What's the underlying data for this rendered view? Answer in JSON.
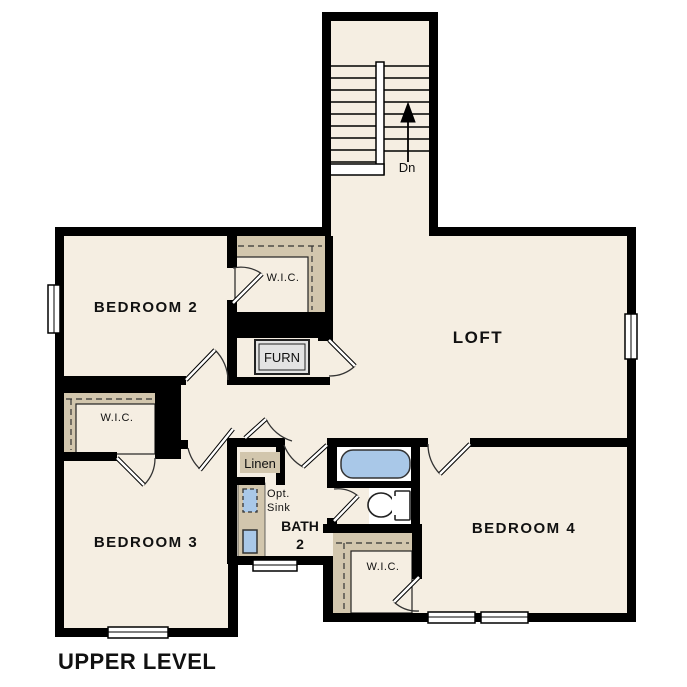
{
  "title": "UPPER LEVEL",
  "colors": {
    "floor": "#f5eee2",
    "wall": "#000000",
    "shelf": "#d2c6ad",
    "fixture": "#a9c8e8",
    "furn": "#e3e3e3",
    "text": "#111111"
  },
  "labels": {
    "bedroom2": "BEDROOM 2",
    "bedroom3": "BEDROOM 3",
    "bedroom4": "BEDROOM 4",
    "loft": "LOFT",
    "bath_line1": "BATH",
    "bath_line2": "2",
    "wic_bedroom2": "W.I.C.",
    "wic_bedroom3": "W.I.C.",
    "wic_bedroom4": "W.I.C.",
    "linen": "Linen",
    "furnace": "FURN",
    "opt_sink_line1": "Opt.",
    "opt_sink_line2": "Sink",
    "stairs_down": "Dn"
  }
}
